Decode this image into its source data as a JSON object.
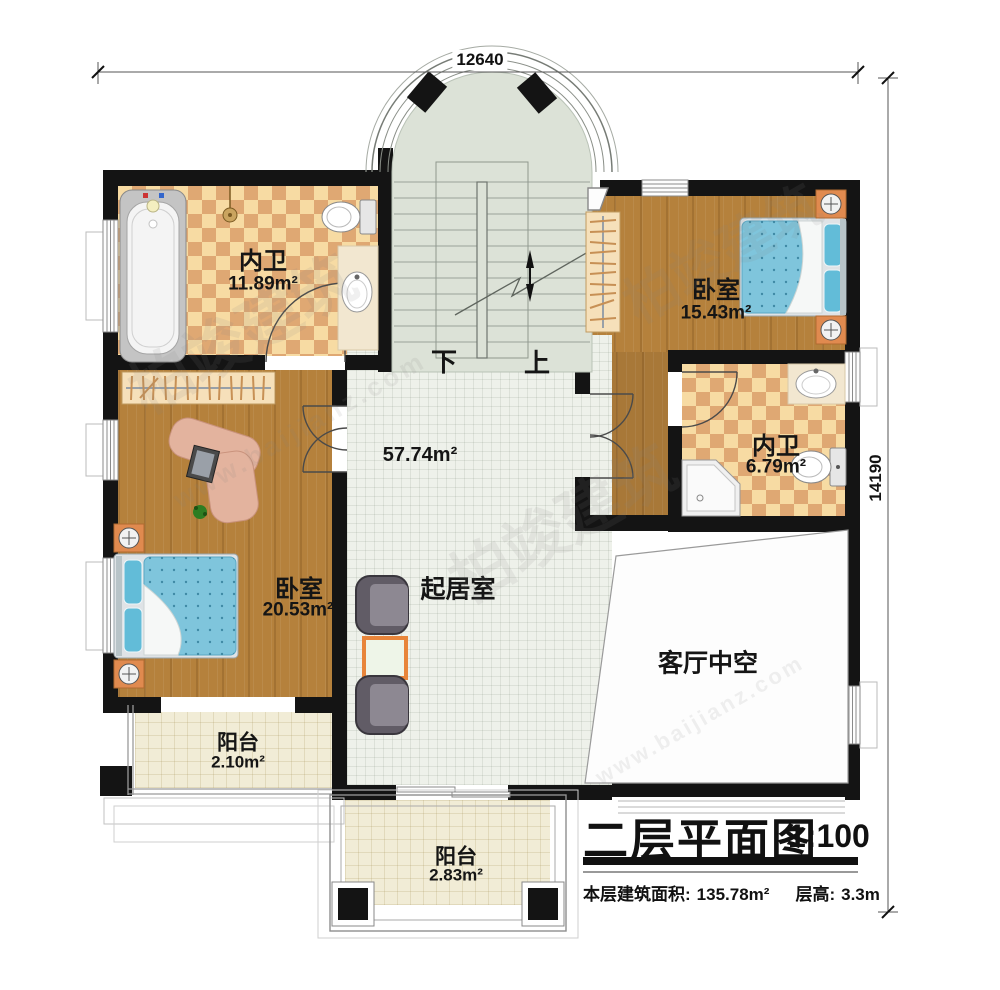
{
  "dimensions": {
    "top_width": "12640",
    "right_height": "14190"
  },
  "stairs": {
    "down": "下",
    "up": "上"
  },
  "rooms": {
    "bath_upper": {
      "name": "内卫",
      "area": "11.89m²"
    },
    "bedroom_right": {
      "name": "卧室",
      "area": "15.43m²"
    },
    "bath_right": {
      "name": "内卫",
      "area": "6.79m²"
    },
    "bedroom_left": {
      "name": "卧室",
      "area": "20.53m²"
    },
    "living": {
      "name": "起居室",
      "area": "57.74m²"
    },
    "void": {
      "name": "客厅中空"
    },
    "balcony_left": {
      "name": "阳台",
      "area": "2.10m²"
    },
    "balcony_bottom": {
      "name": "阳台",
      "area": "2.83m²"
    }
  },
  "title": {
    "text": "二层平面图",
    "scale": "1:100"
  },
  "info": {
    "area_label": "本层建筑面积:",
    "area_value": "135.78m²",
    "height_label": "层高:",
    "height_value": "3.3m"
  },
  "watermark": {
    "brand": "柏竣建筑",
    "url": "www.baijianz.com"
  },
  "colors": {
    "wall": "#141414",
    "wood_floor": "#b5813c",
    "checker_light": "#f7dba3",
    "checker_dark": "#dfa873",
    "living_tile": "#eef1ea",
    "balcony_tile": "#f1ecd6",
    "mattress_blue": "#7fc5dc",
    "nightstand_orange": "#e08a4f",
    "table_border": "#e8853a"
  }
}
